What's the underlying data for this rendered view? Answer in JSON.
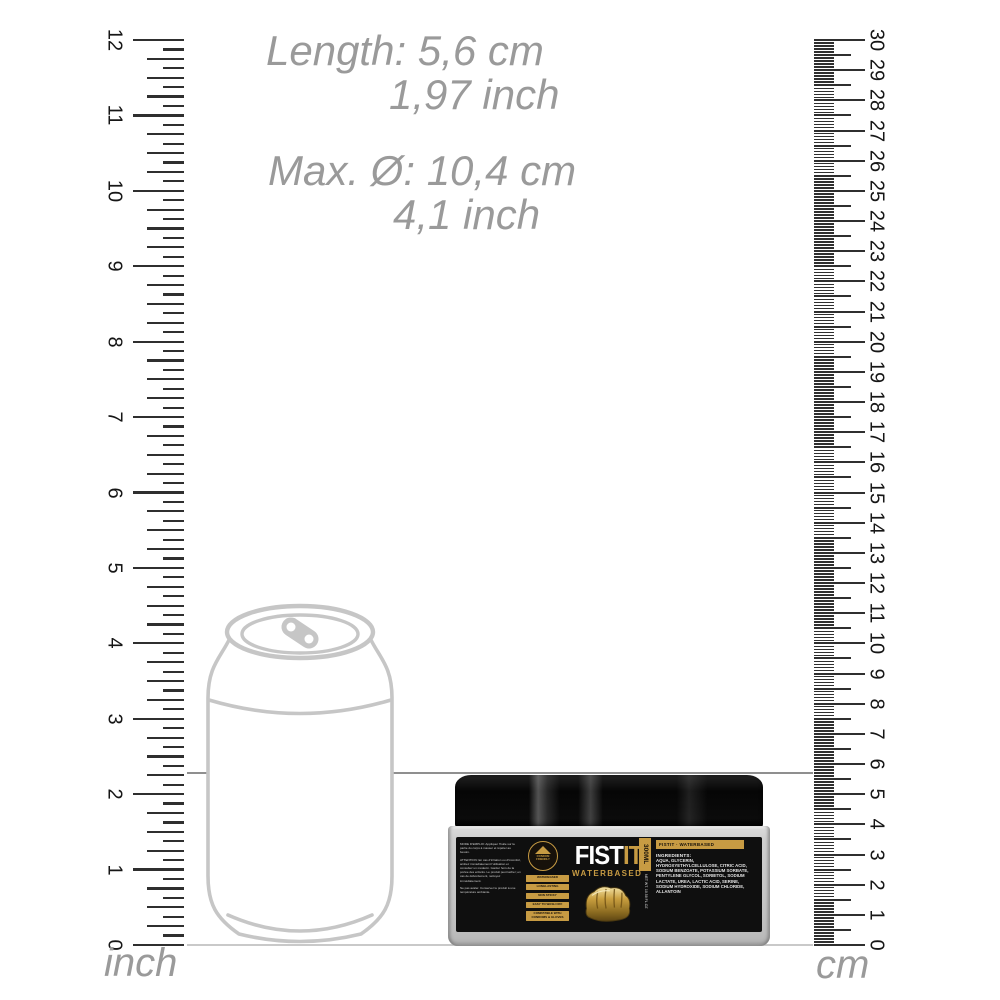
{
  "annotations": {
    "length_cm": "Length: 5,6 cm",
    "length_inch": "1,97 inch",
    "diameter_cm": "Max. Ø: 10,4 cm",
    "diameter_inch": "4,1 inch"
  },
  "rulers": {
    "left": {
      "unit_label": "inch",
      "min": 0,
      "max": 12,
      "subdivisions": 8,
      "numbers": [
        "0",
        "1",
        "2",
        "3",
        "4",
        "5",
        "6",
        "7",
        "8",
        "9",
        "10",
        "11",
        "12"
      ]
    },
    "right": {
      "unit_label": "cm",
      "min": 0,
      "max": 30,
      "subdivisions": 10,
      "numbers": [
        "0",
        "1",
        "2",
        "3",
        "4",
        "5",
        "6",
        "7",
        "8",
        "9",
        "10",
        "11",
        "12",
        "13",
        "14",
        "15",
        "16",
        "17",
        "18",
        "19",
        "20",
        "21",
        "22",
        "23",
        "24",
        "25",
        "26",
        "27",
        "28",
        "29",
        "30"
      ]
    }
  },
  "product": {
    "brand_first": "FIST",
    "brand_second": "IT",
    "variant": "WATERBASED",
    "volume": "300ML",
    "net_weight": "NET WT. 10.58 FL.OZ",
    "badge": {
      "line1": "CONDOM",
      "line2": "FRIENDLY"
    },
    "features": [
      "WATERBASED",
      "LONGLASTING",
      "NON STICKY",
      "EASY TO WASH OFF",
      "COMPATIBLE WITH CONDOMS & GLOVES"
    ],
    "right_band": "FISTIT · WATERBASED",
    "ingredients_title": "INGREDIENTS:",
    "ingredients": "AQUA, GLYCERIN, HYDROXYETHYLCELLULOSE, CITRIC ACID, SODIUM BENZOATE, POTASSIUM SORBATE, PENTYLENE GLYCOL, SORBITOL, SODIUM LACTATE, UREA, LACTIC ACID, SERINE, SODIUM HYDROXIDE, SODIUM CHLORIDE, ALLANTOIN",
    "usage_text": [
      "MODE D'EMPLOI: Appliquer l'huile sur la partie du corps à masser et répéter au besoin.",
      "ATTENTION: En cas d'irritation ou d'inconfort, arrêtez immédiatement l'utilisation et consultez un médecin. Garder hors de la portée des enfants. Le produit peut tacher; en cas de débordement, nettoyez immédiatement.",
      "Ne pas avaler. Conserver le produit à une température ambiante."
    ]
  },
  "colors": {
    "gold": "#c79b43",
    "label_black": "#0f0f0f",
    "annotation_gray": "#9a9a9a",
    "outline_gray": "#c6c6c6",
    "tick_dark": "#2f2f2f"
  }
}
